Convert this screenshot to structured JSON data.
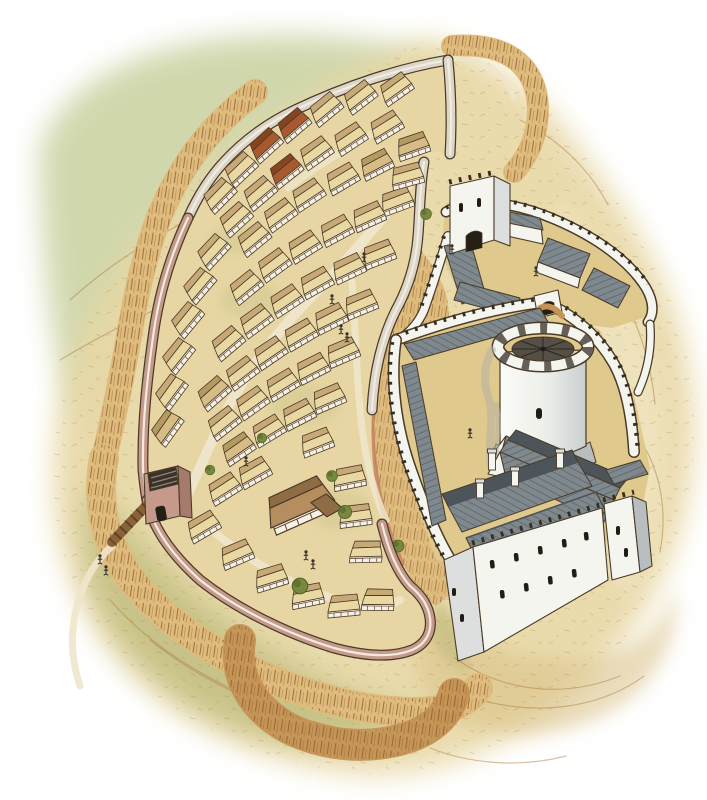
{
  "palette": {
    "page": "#ffffff",
    "hillGreen": "#ccd3a4",
    "hillGreenDeep": "#b7c28c",
    "sand": "#e8d8a6",
    "sandLight": "#f2e8c8",
    "sandDeep": "#d9c186",
    "olive": "#b9b878",
    "oliveDeep": "#9aa05e",
    "bankLight": "#dfbc7e",
    "bank": "#c49254",
    "bankDeep": "#a9773c",
    "bankRed": "#c07f5e",
    "hatch": "#8a5a28",
    "ink": "#4a3a28",
    "inkDark": "#352e22",
    "inkSoft": "#6b563c",
    "townWallPink": "#c69a8a",
    "townWallPinkDeep": "#a47b6d",
    "townWallGrey": "#dcd6c8",
    "wallWalk": "#f2ece0",
    "roofCream": "#e9d8a2",
    "roofCreamDeep": "#c6a976",
    "roofRed": "#a8592f",
    "roofRedDeep": "#87451f",
    "roofTan": "#d7bd85",
    "roofTanDeep": "#b49a61",
    "roofBrown": "#b68d5e",
    "roofBrownDeep": "#8f6c43",
    "timber": "#5e462e",
    "castleWhite": "#f5f5f0",
    "castleShade": "#dcdfdd",
    "castleDeep": "#b8bec0",
    "slate": "#7e888d",
    "slateDeep": "#4d555a",
    "courtyard": "#dfc98c",
    "keepIn": "#554f46",
    "pathLight": "#efe6cc",
    "tree": "#77883f",
    "treeDeep": "#4f6328",
    "smoke": "#b5b0a6",
    "figure": "#3a332a",
    "bridgeWood": "#8a6238"
  },
  "scene": {
    "alt": "Aerial watercolour reconstruction of a medieval walled town with timber-framed houses beside a stone castle with a round keep, great hall, baileys and earthwork defences",
    "town": {
      "houses": [
        {
          "x": 398,
          "y": 92,
          "r": -30,
          "c": "cream"
        },
        {
          "x": 362,
          "y": 100,
          "r": -32,
          "c": "cream"
        },
        {
          "x": 328,
          "y": 112,
          "r": -34,
          "c": "cream"
        },
        {
          "x": 296,
          "y": 128,
          "r": -35,
          "c": "red"
        },
        {
          "x": 268,
          "y": 148,
          "r": -37,
          "c": "red"
        },
        {
          "x": 243,
          "y": 172,
          "r": -38,
          "c": "cream"
        },
        {
          "x": 222,
          "y": 198,
          "r": -40,
          "c": "cream"
        },
        {
          "x": 388,
          "y": 130,
          "r": -26,
          "c": "cream"
        },
        {
          "x": 352,
          "y": 142,
          "r": -28,
          "c": "cream"
        },
        {
          "x": 318,
          "y": 156,
          "r": -30,
          "c": "cream"
        },
        {
          "x": 288,
          "y": 174,
          "r": -33,
          "c": "red"
        },
        {
          "x": 262,
          "y": 196,
          "r": -35,
          "c": "cream"
        },
        {
          "x": 238,
          "y": 222,
          "r": -37,
          "c": "cream"
        },
        {
          "x": 378,
          "y": 168,
          "r": -22,
          "c": "tan"
        },
        {
          "x": 344,
          "y": 182,
          "r": -25,
          "c": "cream"
        },
        {
          "x": 310,
          "y": 198,
          "r": -28,
          "c": "cream"
        },
        {
          "x": 282,
          "y": 218,
          "r": -31,
          "c": "cream"
        },
        {
          "x": 256,
          "y": 242,
          "r": -34,
          "c": "cream"
        },
        {
          "x": 216,
          "y": 254,
          "r": -42,
          "c": "cream"
        },
        {
          "x": 202,
          "y": 288,
          "r": -44,
          "c": "cream"
        },
        {
          "x": 190,
          "y": 322,
          "r": -45,
          "c": "cream"
        },
        {
          "x": 181,
          "y": 358,
          "r": -46,
          "c": "cream"
        },
        {
          "x": 174,
          "y": 394,
          "r": -48,
          "c": "cream"
        },
        {
          "x": 170,
          "y": 430,
          "r": -49,
          "c": "tan"
        },
        {
          "x": 398,
          "y": 205,
          "r": -15,
          "c": "cream"
        },
        {
          "x": 370,
          "y": 220,
          "r": -19,
          "c": "cream"
        },
        {
          "x": 338,
          "y": 234,
          "r": -23,
          "c": "cream"
        },
        {
          "x": 306,
          "y": 250,
          "r": -27,
          "c": "cream"
        },
        {
          "x": 276,
          "y": 268,
          "r": -31,
          "c": "cream"
        },
        {
          "x": 248,
          "y": 290,
          "r": -34,
          "c": "cream"
        },
        {
          "x": 380,
          "y": 258,
          "r": -16,
          "c": "cream"
        },
        {
          "x": 350,
          "y": 272,
          "r": -20,
          "c": "cream"
        },
        {
          "x": 318,
          "y": 286,
          "r": -24,
          "c": "cream"
        },
        {
          "x": 288,
          "y": 304,
          "r": -28,
          "c": "cream"
        },
        {
          "x": 258,
          "y": 324,
          "r": -31,
          "c": "cream"
        },
        {
          "x": 230,
          "y": 346,
          "r": -35,
          "c": "cream"
        },
        {
          "x": 362,
          "y": 308,
          "r": -17,
          "c": "cream"
        },
        {
          "x": 332,
          "y": 322,
          "r": -21,
          "c": "cream"
        },
        {
          "x": 302,
          "y": 338,
          "r": -25,
          "c": "cream"
        },
        {
          "x": 272,
          "y": 356,
          "r": -29,
          "c": "cream"
        },
        {
          "x": 244,
          "y": 376,
          "r": -32,
          "c": "cream"
        },
        {
          "x": 216,
          "y": 396,
          "r": -36,
          "c": "tan"
        },
        {
          "x": 344,
          "y": 356,
          "r": -18,
          "c": "cream"
        },
        {
          "x": 314,
          "y": 372,
          "r": -22,
          "c": "cream"
        },
        {
          "x": 284,
          "y": 388,
          "r": -26,
          "c": "cream"
        },
        {
          "x": 254,
          "y": 406,
          "r": -30,
          "c": "cream"
        },
        {
          "x": 226,
          "y": 426,
          "r": -33,
          "c": "cream"
        },
        {
          "x": 330,
          "y": 402,
          "r": -18,
          "c": "cream"
        },
        {
          "x": 300,
          "y": 418,
          "r": -22,
          "c": "cream"
        },
        {
          "x": 270,
          "y": 434,
          "r": -26,
          "c": "cream"
        },
        {
          "x": 240,
          "y": 452,
          "r": -29,
          "c": "tan"
        },
        {
          "x": 318,
          "y": 446,
          "r": -16,
          "c": "cream"
        },
        {
          "x": 256,
          "y": 476,
          "r": -24,
          "c": "cream"
        },
        {
          "x": 226,
          "y": 492,
          "r": -27,
          "c": "cream"
        },
        {
          "x": 205,
          "y": 530,
          "r": -25,
          "c": "cream"
        },
        {
          "x": 238,
          "y": 558,
          "r": -18,
          "c": "cream"
        },
        {
          "x": 272,
          "y": 582,
          "r": -12,
          "c": "cream"
        },
        {
          "x": 308,
          "y": 600,
          "r": -6,
          "c": "cream"
        },
        {
          "x": 344,
          "y": 610,
          "r": 0,
          "c": "cream"
        },
        {
          "x": 378,
          "y": 604,
          "r": 6,
          "c": "cream"
        },
        {
          "x": 350,
          "y": 482,
          "r": -6,
          "c": "cream"
        },
        {
          "x": 356,
          "y": 520,
          "r": -2,
          "c": "cream"
        },
        {
          "x": 366,
          "y": 556,
          "r": 4,
          "c": "cream"
        },
        {
          "x": 414,
          "y": 150,
          "r": -14,
          "c": "tan"
        },
        {
          "x": 408,
          "y": 180,
          "r": -10,
          "c": "cream"
        }
      ]
    },
    "trees": [
      {
        "x": 345,
        "y": 512,
        "s": 1.1
      },
      {
        "x": 300,
        "y": 586,
        "s": 1.3
      },
      {
        "x": 398,
        "y": 546,
        "s": 1.0
      },
      {
        "x": 426,
        "y": 214,
        "s": 0.9
      },
      {
        "x": 262,
        "y": 438,
        "s": 0.8
      },
      {
        "x": 332,
        "y": 476,
        "s": 0.9
      },
      {
        "x": 210,
        "y": 470,
        "s": 0.8
      }
    ],
    "figures": [
      {
        "x": 341,
        "y": 330
      },
      {
        "x": 347,
        "y": 338
      },
      {
        "x": 332,
        "y": 300
      },
      {
        "x": 306,
        "y": 556
      },
      {
        "x": 313,
        "y": 565
      },
      {
        "x": 100,
        "y": 560
      },
      {
        "x": 106,
        "y": 571
      },
      {
        "x": 536,
        "y": 272
      },
      {
        "x": 470,
        "y": 434
      },
      {
        "x": 364,
        "y": 258
      },
      {
        "x": 246,
        "y": 462
      },
      {
        "x": 452,
        "y": 250
      }
    ]
  }
}
